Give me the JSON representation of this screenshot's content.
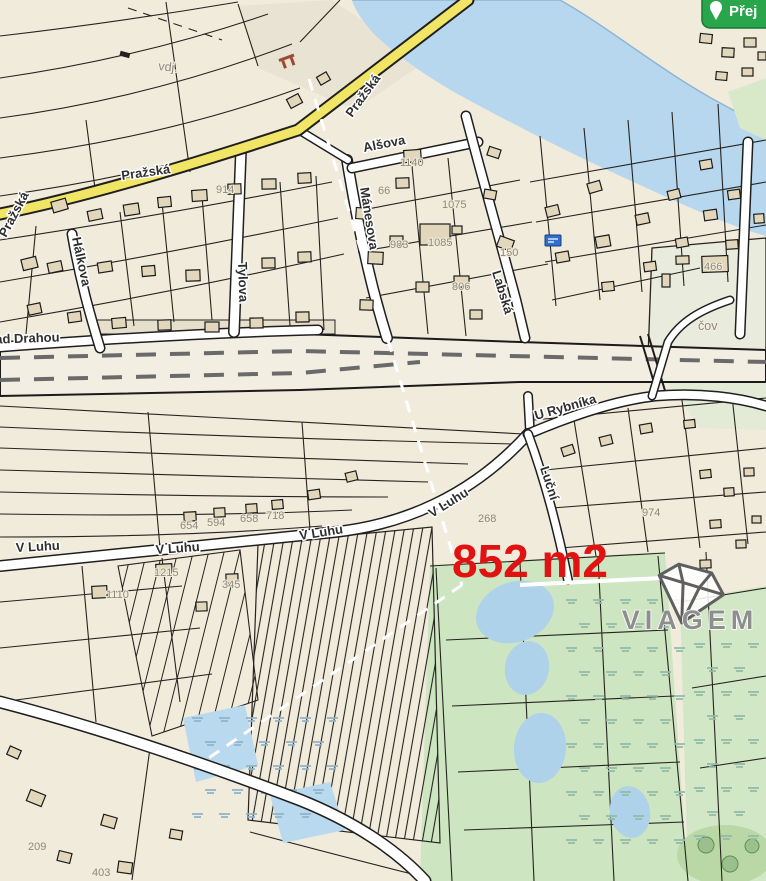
{
  "app": {
    "goto_button": {
      "visible_text": "Přej",
      "color": "#29a64b"
    }
  },
  "measurement": {
    "area_label": "852 m2",
    "color": "#e11212"
  },
  "watermark": {
    "brand": "VIAGEM",
    "icon": "gem-diamond-icon",
    "color": "#8e8e8e"
  },
  "map": {
    "street_labels": [
      {
        "text": "Pražská",
        "x": 6,
        "y": 238,
        "rot": -62
      },
      {
        "text": "Pražská",
        "x": 122,
        "y": 180,
        "rot": -8
      },
      {
        "text": "Pražská",
        "x": 352,
        "y": 118,
        "rot": -54
      },
      {
        "text": "Nad Drahou",
        "x": -14,
        "y": 344,
        "rot": -2
      },
      {
        "text": "Alšova",
        "x": 364,
        "y": 152,
        "rot": -11
      },
      {
        "text": "Mánesova",
        "x": 360,
        "y": 188,
        "rot": 81
      },
      {
        "text": "Tylova",
        "x": 238,
        "y": 262,
        "rot": 88
      },
      {
        "text": "Hálkova",
        "x": 72,
        "y": 238,
        "rot": 78
      },
      {
        "text": "Labská",
        "x": 492,
        "y": 272,
        "rot": 73
      },
      {
        "text": "U Rybníka",
        "x": 536,
        "y": 420,
        "rot": -16
      },
      {
        "text": "V Luhu",
        "x": 16,
        "y": 552,
        "rot": -3
      },
      {
        "text": "V Luhu",
        "x": 156,
        "y": 554,
        "rot": -4
      },
      {
        "text": "V Luhu",
        "x": 300,
        "y": 540,
        "rot": -9
      },
      {
        "text": "V Luhu",
        "x": 432,
        "y": 518,
        "rot": -32
      },
      {
        "text": "Luční",
        "x": 540,
        "y": 468,
        "rot": 72
      },
      {
        "text": "vdj.",
        "x": 158,
        "y": 70,
        "rot": 6,
        "minor": true
      },
      {
        "text": "čov",
        "x": 698,
        "y": 330,
        "rot": 0,
        "minor": true
      }
    ],
    "house_numbers": [
      {
        "n": "1085",
        "x": 428,
        "y": 246
      },
      {
        "n": "806",
        "x": 452,
        "y": 290
      },
      {
        "n": "983",
        "x": 390,
        "y": 248
      },
      {
        "n": "1075",
        "x": 442,
        "y": 208
      },
      {
        "n": "66",
        "x": 378,
        "y": 194
      },
      {
        "n": "1140",
        "x": 400,
        "y": 166
      },
      {
        "n": "914",
        "x": 216,
        "y": 193
      },
      {
        "n": "466",
        "x": 704,
        "y": 270
      },
      {
        "n": "150",
        "x": 500,
        "y": 256
      },
      {
        "n": "654",
        "x": 180,
        "y": 529
      },
      {
        "n": "594",
        "x": 207,
        "y": 526
      },
      {
        "n": "658",
        "x": 240,
        "y": 522
      },
      {
        "n": "718",
        "x": 266,
        "y": 519
      },
      {
        "n": "1215",
        "x": 154,
        "y": 576
      },
      {
        "n": "345",
        "x": 222,
        "y": 588
      },
      {
        "n": "1110",
        "x": 106,
        "y": 598
      },
      {
        "n": "268",
        "x": 478,
        "y": 522
      },
      {
        "n": "974",
        "x": 642,
        "y": 516
      },
      {
        "n": "209",
        "x": 28,
        "y": 850
      },
      {
        "n": "403",
        "x": 92,
        "y": 876
      }
    ]
  }
}
